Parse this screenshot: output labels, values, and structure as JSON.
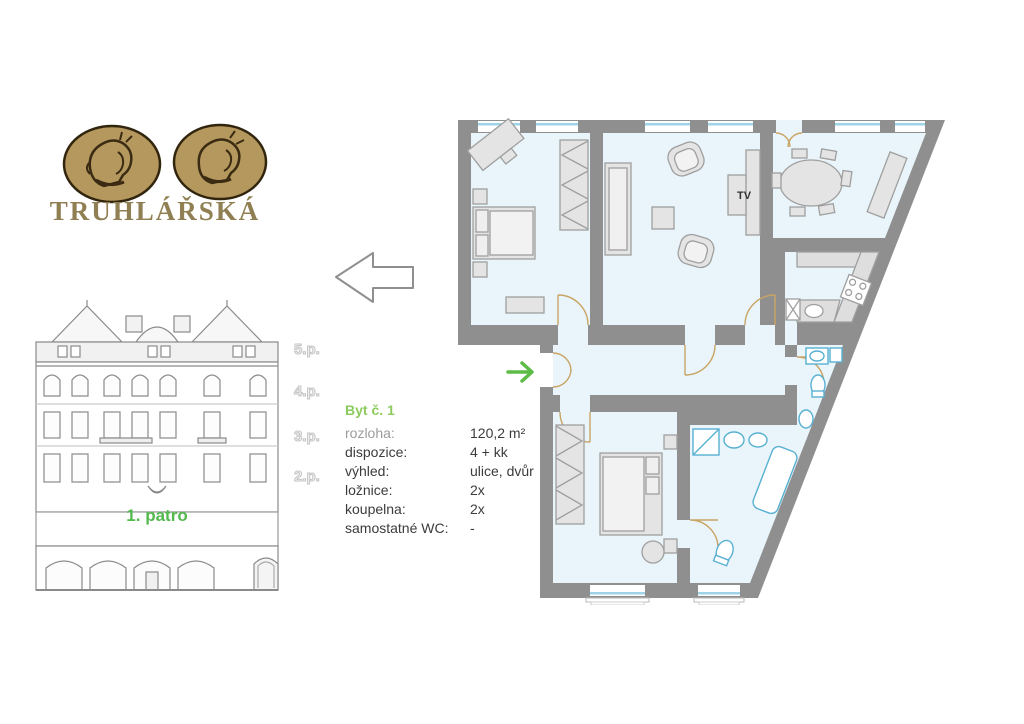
{
  "logo": {
    "brand": "TRUHLÁŘSKÁ",
    "medallions": [
      "classical-profile-coin-left",
      "classical-profile-coin-right"
    ],
    "coin_color": "#b5985e",
    "text_color": "#8f7f53"
  },
  "facade": {
    "floor_labels": [
      "5.p.",
      "4.p.",
      "3.p.",
      "2.p."
    ],
    "highlight_label": "1. patro",
    "highlight_color": "#53b94e"
  },
  "pointer": {
    "direction_icon": "left-arrow-icon"
  },
  "apartment": {
    "title": "Byt č. 1",
    "title_color": "#8ccb5e",
    "details": [
      {
        "label": "rozloha:",
        "value": "120,2 m²"
      },
      {
        "label": "dispozice:",
        "value": "4 + kk"
      },
      {
        "label": "výhled:",
        "value": "ulice, dvůr"
      },
      {
        "label": "ložnice:",
        "value": "2x"
      },
      {
        "label": "koupelna:",
        "value": "2x"
      },
      {
        "label": "samostatné WC:",
        "value": "-"
      }
    ]
  },
  "floor_plan": {
    "tv_label": "TV",
    "entrance_arrow_color": "#5dbb46",
    "wall_color": "#8f8f8f",
    "floor_color": "#e9f5fa",
    "furniture_color": "#e4e4e4",
    "fixture_color": "#58b0d2",
    "door_color": "#c9a464",
    "window_color": "#9fd4e8"
  }
}
